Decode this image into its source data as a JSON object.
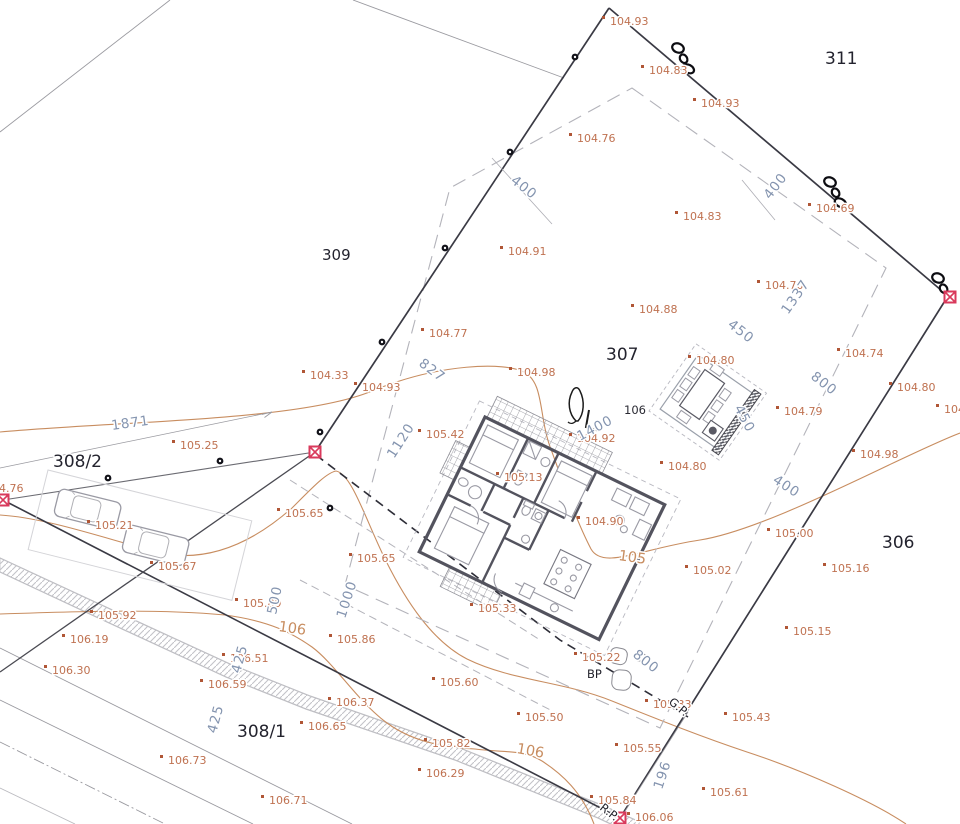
{
  "plan": {
    "colors": {
      "elevation_text": "#bf7150",
      "elevation_dot": "#b05636",
      "dimension_text": "#8494af",
      "contour_line": "#c88d60",
      "parcel_text": "#23232e",
      "boundary_line": "#3a3a44",
      "marker_red": "#d93a5c",
      "wall": "#53535e"
    },
    "parcels": [
      {
        "label": "311",
        "x": 825,
        "y": 64,
        "size": 17
      },
      {
        "label": "309",
        "x": 322,
        "y": 260,
        "size": 15
      },
      {
        "label": "307",
        "x": 606,
        "y": 360,
        "size": 17
      },
      {
        "label": "308/2",
        "x": 53,
        "y": 467,
        "size": 17
      },
      {
        "label": "306",
        "x": 882,
        "y": 548,
        "size": 17
      },
      {
        "label": "308/1",
        "x": 237,
        "y": 737,
        "size": 17
      }
    ],
    "elevation_points": [
      {
        "t": "104.93",
        "x": 610,
        "y": 25
      },
      {
        "t": "104.83",
        "x": 649,
        "y": 74
      },
      {
        "t": "104.93",
        "x": 701,
        "y": 107
      },
      {
        "t": "104.76",
        "x": 577,
        "y": 142
      },
      {
        "t": "104.83",
        "x": 683,
        "y": 220
      },
      {
        "t": "104.69",
        "x": 816,
        "y": 212
      },
      {
        "t": "104.91",
        "x": 508,
        "y": 255
      },
      {
        "t": "104.70",
        "x": 765,
        "y": 289
      },
      {
        "t": "104.88",
        "x": 639,
        "y": 313
      },
      {
        "t": "104.77",
        "x": 429,
        "y": 337
      },
      {
        "t": "104.74",
        "x": 845,
        "y": 357
      },
      {
        "t": "104.80",
        "x": 696,
        "y": 364
      },
      {
        "t": "104.33",
        "x": 310,
        "y": 379
      },
      {
        "t": "104.93",
        "x": 362,
        "y": 391
      },
      {
        "t": "104.80",
        "x": 897,
        "y": 391
      },
      {
        "t": "104.98",
        "x": 517,
        "y": 376
      },
      {
        "t": "104.79",
        "x": 784,
        "y": 415
      },
      {
        "t": "104.9",
        "x": 944,
        "y": 413
      },
      {
        "t": "105.42",
        "x": 426,
        "y": 438
      },
      {
        "t": "104.92",
        "x": 577,
        "y": 442
      },
      {
        "t": "105.25",
        "x": 180,
        "y": 449
      },
      {
        "t": "105.13",
        "x": 504,
        "y": 481
      },
      {
        "t": "104.76",
        "x": -15,
        "y": 492,
        "dot": false
      },
      {
        "t": "105.65",
        "x": 285,
        "y": 517
      },
      {
        "t": "105.21",
        "x": 95,
        "y": 529
      },
      {
        "t": "104.90",
        "x": 585,
        "y": 525
      },
      {
        "t": "105.00",
        "x": 775,
        "y": 537
      },
      {
        "t": "105.67",
        "x": 158,
        "y": 570
      },
      {
        "t": "105.02",
        "x": 693,
        "y": 574
      },
      {
        "t": "105.16",
        "x": 831,
        "y": 572
      },
      {
        "t": "105.65",
        "x": 357,
        "y": 562
      },
      {
        "t": "104.80",
        "x": 668,
        "y": 470
      },
      {
        "t": "104.98",
        "x": 860,
        "y": 458
      },
      {
        "t": "105.33",
        "x": 478,
        "y": 612
      },
      {
        "t": "105.89",
        "x": 243,
        "y": 607
      },
      {
        "t": "105.92",
        "x": 98,
        "y": 619
      },
      {
        "t": "106.19",
        "x": 70,
        "y": 643
      },
      {
        "t": "106.30",
        "x": 52,
        "y": 674
      },
      {
        "t": "106.59",
        "x": 208,
        "y": 688
      },
      {
        "t": "106.51",
        "x": 230,
        "y": 662
      },
      {
        "t": "105.86",
        "x": 337,
        "y": 643
      },
      {
        "t": "106.37",
        "x": 336,
        "y": 706
      },
      {
        "t": "106.65",
        "x": 308,
        "y": 730
      },
      {
        "t": "105.60",
        "x": 440,
        "y": 686
      },
      {
        "t": "105.50",
        "x": 525,
        "y": 721
      },
      {
        "t": "105.22",
        "x": 582,
        "y": 661
      },
      {
        "t": "105.82",
        "x": 432,
        "y": 747
      },
      {
        "t": "106.29",
        "x": 426,
        "y": 777
      },
      {
        "t": "105.55",
        "x": 623,
        "y": 752
      },
      {
        "t": "105.33",
        "x": 653,
        "y": 708
      },
      {
        "t": "105.43",
        "x": 732,
        "y": 721
      },
      {
        "t": "105.15",
        "x": 793,
        "y": 635
      },
      {
        "t": "105.61",
        "x": 710,
        "y": 796
      },
      {
        "t": "105.84",
        "x": 598,
        "y": 804
      },
      {
        "t": "106.06",
        "x": 635,
        "y": 821
      },
      {
        "t": "106.73",
        "x": 168,
        "y": 764
      },
      {
        "t": "106.71",
        "x": 269,
        "y": 804
      }
    ],
    "dimension_labels": [
      {
        "t": "400",
        "x": 510,
        "y": 182,
        "r": 38
      },
      {
        "t": "400",
        "x": 770,
        "y": 200,
        "r": -52
      },
      {
        "t": "1337",
        "x": 788,
        "y": 315,
        "r": -55
      },
      {
        "t": "450",
        "x": 727,
        "y": 326,
        "r": 38
      },
      {
        "t": "800",
        "x": 810,
        "y": 378,
        "r": 38
      },
      {
        "t": "450",
        "x": 734,
        "y": 408,
        "r": 62
      },
      {
        "t": "827",
        "x": 418,
        "y": 365,
        "r": 37
      },
      {
        "t": "1120",
        "x": 394,
        "y": 459,
        "r": -57
      },
      {
        "t": "1400",
        "x": 580,
        "y": 441,
        "r": -28
      },
      {
        "t": "1871",
        "x": 112,
        "y": 430,
        "r": -8
      },
      {
        "t": "400",
        "x": 772,
        "y": 482,
        "r": 33
      },
      {
        "t": "500",
        "x": 276,
        "y": 615,
        "r": -78
      },
      {
        "t": "425",
        "x": 240,
        "y": 674,
        "r": -75
      },
      {
        "t": "425",
        "x": 216,
        "y": 734,
        "r": -75
      },
      {
        "t": "1000",
        "x": 345,
        "y": 619,
        "r": -72
      },
      {
        "t": "800",
        "x": 632,
        "y": 656,
        "r": 38
      },
      {
        "t": "196",
        "x": 662,
        "y": 790,
        "r": -72
      }
    ],
    "contour_labels": [
      {
        "t": "106",
        "x": 278,
        "y": 631,
        "r": 8,
        "kind": "orange"
      },
      {
        "t": "106",
        "x": 516,
        "y": 753,
        "r": 10,
        "kind": "orange"
      },
      {
        "t": "105",
        "x": 618,
        "y": 560,
        "r": 8,
        "kind": "orange"
      },
      {
        "t": "106",
        "x": 624,
        "y": 414,
        "r": 0,
        "kind": "black"
      }
    ],
    "survey_notes": [
      {
        "t": "BP",
        "x": 587,
        "y": 678,
        "r": 0
      },
      {
        "t": "G.P.",
        "x": 668,
        "y": 703,
        "r": 40
      },
      {
        "t": "R.P.",
        "x": 599,
        "y": 809,
        "r": 38
      }
    ],
    "red_markers": [
      {
        "x": 3,
        "y": 500
      },
      {
        "x": 315,
        "y": 452
      },
      {
        "x": 950,
        "y": 297
      },
      {
        "x": 620,
        "y": 818
      }
    ],
    "boundary_dots": [
      {
        "x": 575,
        "y": 57
      },
      {
        "x": 510,
        "y": 152
      },
      {
        "x": 445,
        "y": 248
      },
      {
        "x": 382,
        "y": 342
      },
      {
        "x": 320,
        "y": 432
      },
      {
        "x": 220,
        "y": 461
      },
      {
        "x": 108,
        "y": 478
      },
      {
        "x": 330,
        "y": 508
      }
    ],
    "fence_symbols": [
      {
        "x": 678,
        "y": 48,
        "r": 38,
        "n": 3
      },
      {
        "x": 830,
        "y": 182,
        "r": 38,
        "n": 3
      },
      {
        "x": 938,
        "y": 278,
        "r": 38,
        "n": 2
      }
    ]
  }
}
